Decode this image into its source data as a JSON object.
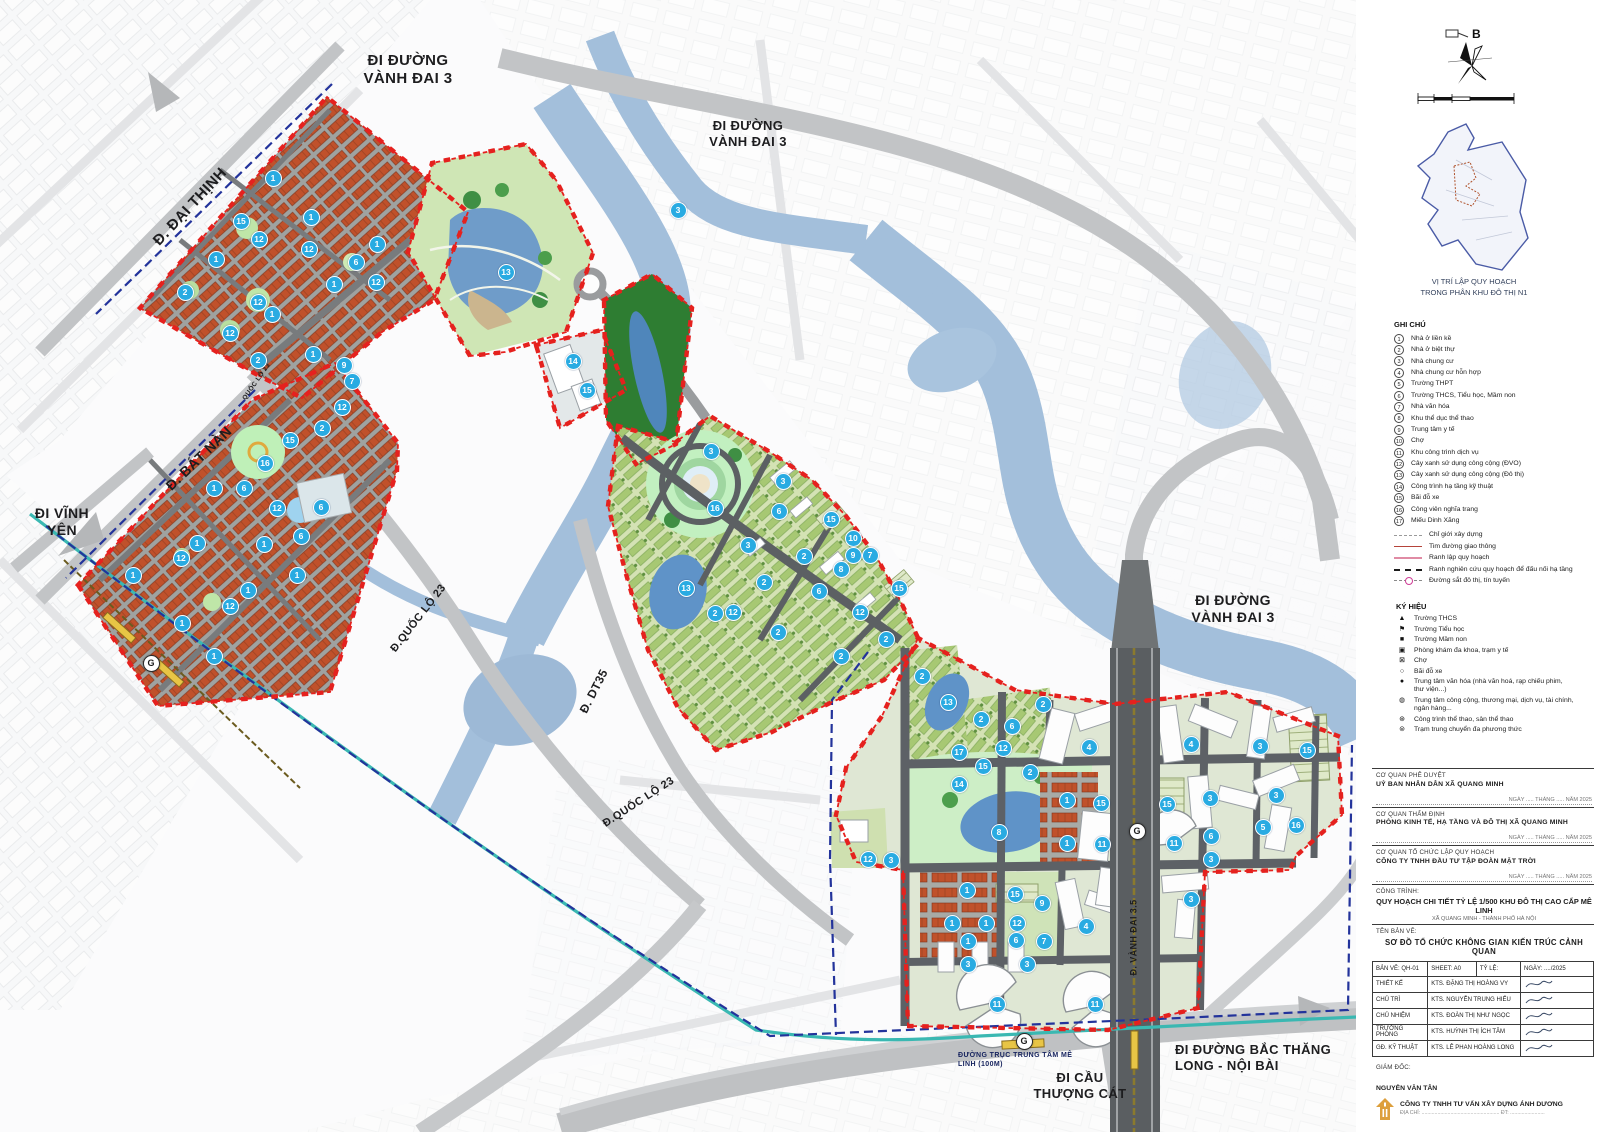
{
  "colors": {
    "marker": "#29abe2",
    "boundary_red": "#e5211e",
    "research_navy": "#23339b",
    "rail_teal": "#3ab8b2",
    "orange_block": "#c0512b",
    "water": "#a3bfdb"
  },
  "compass": {
    "label": "B"
  },
  "inset": {
    "caption1": "VỊ TRÍ LẬP QUY HOẠCH",
    "caption2": "TRONG PHÂN KHU ĐÔ THỊ N1"
  },
  "map": {
    "station_label": "G",
    "stations": [
      {
        "x": 150,
        "y": 662
      },
      {
        "x": 1136,
        "y": 830
      },
      {
        "x": 1023,
        "y": 1040
      }
    ],
    "road_labels": [
      {
        "text": "ĐI ĐƯỜNG\nVÀNH ĐAI 3",
        "x": 338,
        "y": 52,
        "w": 140,
        "rot": 0,
        "size": 15
      },
      {
        "text": "ĐI ĐƯỜNG\nVÀNH ĐAI 3",
        "x": 688,
        "y": 118,
        "w": 120,
        "rot": 0,
        "size": 13
      },
      {
        "text": "ĐI ĐƯỜNG\nVÀNH ĐAI 3",
        "x": 1163,
        "y": 592,
        "w": 140,
        "rot": 0,
        "size": 14
      },
      {
        "text": "Đ. ĐẠI THỊNH",
        "x": 118,
        "y": 198,
        "w": 145,
        "rot": -47,
        "size": 15
      },
      {
        "text": "Đ. BÁT NÀN",
        "x": 133,
        "y": 450,
        "w": 132,
        "rot": -44,
        "size": 14
      },
      {
        "text": "ĐI VĨNH\nYÊN",
        "x": 20,
        "y": 505,
        "w": 84,
        "rot": 0,
        "size": 14
      },
      {
        "text": "Đ.QUỐC LỘ 23",
        "x": 358,
        "y": 612,
        "w": 122,
        "rot": -52,
        "size": 11
      },
      {
        "text": "Đ.QUỐC LỘ 23",
        "x": 578,
        "y": 796,
        "w": 122,
        "rot": -33,
        "size": 11
      },
      {
        "text": "QUỐC LỘ 23",
        "x": 226,
        "y": 378,
        "w": 62,
        "rot": -55,
        "size": 6.5
      },
      {
        "text": "Đ. DT35",
        "x": 558,
        "y": 684,
        "w": 72,
        "rot": -63,
        "size": 12
      },
      {
        "text": "Đ. VÀNH ĐAI 3.5",
        "x": 1086,
        "y": 932,
        "w": 96,
        "rot": -90,
        "size": 9
      },
      {
        "text": "ĐƯỜNG TRỤC TRUNG TÂM MÊ\nLINH (100M)",
        "x": 958,
        "y": 1052,
        "w": 140,
        "rot": 0,
        "size": 7,
        "color": "#16235e",
        "align": "left"
      },
      {
        "text": "ĐI CẦU\nTHƯỢNG CÁT",
        "x": 1018,
        "y": 1070,
        "w": 124,
        "rot": 0,
        "size": 13
      },
      {
        "text": "ĐI ĐƯỜNG BẮC THĂNG\nLONG - NỘI BÀI",
        "x": 1175,
        "y": 1042,
        "w": 185,
        "rot": 0,
        "size": 13,
        "align": "left"
      }
    ],
    "markers": [
      [
        1,
        272,
        177
      ],
      [
        15,
        240,
        220
      ],
      [
        12,
        258,
        238
      ],
      [
        1,
        310,
        216
      ],
      [
        12,
        308,
        248
      ],
      [
        1,
        215,
        258
      ],
      [
        6,
        355,
        261
      ],
      [
        1,
        376,
        243
      ],
      [
        12,
        375,
        281
      ],
      [
        1,
        333,
        283
      ],
      [
        2,
        184,
        291
      ],
      [
        12,
        257,
        301
      ],
      [
        1,
        271,
        313
      ],
      [
        12,
        229,
        332
      ],
      [
        2,
        257,
        359
      ],
      [
        1,
        312,
        353
      ],
      [
        9,
        343,
        364
      ],
      [
        7,
        351,
        380
      ],
      [
        12,
        341,
        406
      ],
      [
        2,
        321,
        427
      ],
      [
        15,
        289,
        439
      ],
      [
        16,
        264,
        462
      ],
      [
        6,
        243,
        487
      ],
      [
        1,
        213,
        487
      ],
      [
        12,
        276,
        507
      ],
      [
        6,
        320,
        506
      ],
      [
        6,
        300,
        535
      ],
      [
        1,
        196,
        542
      ],
      [
        1,
        263,
        543
      ],
      [
        12,
        180,
        557
      ],
      [
        1,
        132,
        574
      ],
      [
        1,
        296,
        574
      ],
      [
        1,
        247,
        589
      ],
      [
        12,
        229,
        605
      ],
      [
        1,
        181,
        622
      ],
      [
        1,
        213,
        655
      ],
      [
        13,
        505,
        271
      ],
      [
        14,
        572,
        360
      ],
      [
        15,
        586,
        389
      ],
      [
        3,
        677,
        209
      ],
      [
        3,
        710,
        450
      ],
      [
        3,
        782,
        480
      ],
      [
        6,
        778,
        510
      ],
      [
        15,
        830,
        518
      ],
      [
        16,
        714,
        507
      ],
      [
        3,
        747,
        544
      ],
      [
        2,
        803,
        555
      ],
      [
        10,
        852,
        537
      ],
      [
        9,
        852,
        554
      ],
      [
        7,
        869,
        554
      ],
      [
        8,
        840,
        568
      ],
      [
        6,
        818,
        590
      ],
      [
        13,
        685,
        587
      ],
      [
        2,
        763,
        581
      ],
      [
        12,
        732,
        611
      ],
      [
        2,
        714,
        612
      ],
      [
        12,
        859,
        611
      ],
      [
        2,
        777,
        631
      ],
      [
        15,
        898,
        587
      ],
      [
        2,
        885,
        638
      ],
      [
        2,
        840,
        655
      ],
      [
        2,
        921,
        675
      ],
      [
        13,
        947,
        701
      ],
      [
        2,
        1042,
        703
      ],
      [
        2,
        980,
        718
      ],
      [
        6,
        1011,
        725
      ],
      [
        12,
        1002,
        747
      ],
      [
        4,
        1088,
        746
      ],
      [
        17,
        958,
        751
      ],
      [
        15,
        982,
        765
      ],
      [
        2,
        1029,
        771
      ],
      [
        14,
        958,
        783
      ],
      [
        1,
        1066,
        799
      ],
      [
        15,
        1100,
        802
      ],
      [
        8,
        998,
        831
      ],
      [
        1,
        1066,
        842
      ],
      [
        11,
        1101,
        843
      ],
      [
        12,
        867,
        858
      ],
      [
        3,
        890,
        859
      ],
      [
        4,
        1190,
        743
      ],
      [
        3,
        1259,
        745
      ],
      [
        15,
        1306,
        749
      ],
      [
        15,
        1166,
        803
      ],
      [
        3,
        1209,
        797
      ],
      [
        3,
        1275,
        794
      ],
      [
        11,
        1173,
        842
      ],
      [
        6,
        1210,
        835
      ],
      [
        5,
        1262,
        826
      ],
      [
        16,
        1295,
        824
      ],
      [
        3,
        1210,
        858
      ],
      [
        3,
        1190,
        898
      ],
      [
        1,
        966,
        889
      ],
      [
        15,
        1014,
        893
      ],
      [
        9,
        1041,
        902
      ],
      [
        1,
        951,
        922
      ],
      [
        1,
        985,
        922
      ],
      [
        12,
        1016,
        922
      ],
      [
        4,
        1085,
        925
      ],
      [
        6,
        1015,
        939
      ],
      [
        7,
        1043,
        940
      ],
      [
        1,
        967,
        940
      ],
      [
        3,
        967,
        963
      ],
      [
        3,
        1026,
        963
      ],
      [
        11,
        996,
        1003
      ],
      [
        11,
        1094,
        1003
      ]
    ]
  },
  "legend": {
    "title": "GHI CHÚ",
    "items": [
      {
        "num": 1,
        "label": "Nhà ở liền kề"
      },
      {
        "num": 2,
        "label": "Nhà ở biệt thự"
      },
      {
        "num": 3,
        "label": "Nhà chung cư"
      },
      {
        "num": 4,
        "label": "Nhà chung cư hỗn hợp"
      },
      {
        "num": 5,
        "label": "Trường THPT"
      },
      {
        "num": 6,
        "label": "Trường THCS, Tiểu học, Mầm non"
      },
      {
        "num": 7,
        "label": "Nhà văn hóa"
      },
      {
        "num": 8,
        "label": "Khu thể dục thể thao"
      },
      {
        "num": 9,
        "label": "Trung tâm y tế"
      },
      {
        "num": 10,
        "label": "Chợ"
      },
      {
        "num": 11,
        "label": "Khu công trình dịch vụ"
      },
      {
        "num": 12,
        "label": "Cây xanh sử dụng công cộng (ĐVO)"
      },
      {
        "num": 13,
        "label": "Cây xanh sử dụng công cộng (Đô thị)"
      },
      {
        "num": 14,
        "label": "Công trình hạ tầng kỹ thuật"
      },
      {
        "num": 15,
        "label": "Bãi đỗ xe"
      },
      {
        "num": 16,
        "label": "Công viên nghĩa trang"
      },
      {
        "num": 17,
        "label": "Miếu Dinh Xăng"
      }
    ],
    "lines": [
      {
        "style": "construction",
        "label": "Chỉ giới xây dựng"
      },
      {
        "style": "road-axis",
        "label": "Tim đường giao thông"
      },
      {
        "style": "planning",
        "label": "Ranh lập quy hoạch"
      },
      {
        "style": "research",
        "label": "Ranh nghiên cứu quy hoạch để đấu nối hạ tầng"
      },
      {
        "style": "rail",
        "label": "Đường sắt đô thị, tín tuyến"
      }
    ]
  },
  "symbols": {
    "title": "KÝ HIỆU",
    "items": [
      {
        "glyph": "▲",
        "label": "Trường THCS"
      },
      {
        "glyph": "⚑",
        "label": "Trường Tiểu học"
      },
      {
        "glyph": "■",
        "label": "Trường Mầm non"
      },
      {
        "glyph": "▣",
        "label": "Phòng khám đa khoa, trạm y tế"
      },
      {
        "glyph": "⊠",
        "label": "Chợ"
      },
      {
        "glyph": "○",
        "label": "Bãi đỗ xe"
      },
      {
        "glyph": "●",
        "label": "Trung tâm văn hóa (nhà văn hoá, rạp chiếu phim, thư viện...)"
      },
      {
        "glyph": "◍",
        "label": "Trung tâm công cộng, thương mại, dịch vụ, tài chính, ngân hàng..."
      },
      {
        "glyph": "⊛",
        "label": "Công trình thể thao, sân thể thao"
      },
      {
        "glyph": "⊜",
        "label": "Trạm trung chuyển đa phương thức"
      }
    ]
  },
  "titleblock": {
    "approve_label": "CƠ QUAN PHÊ DUYỆT",
    "approve_value": "UỶ BAN NHÂN DÂN XÃ QUANG MINH",
    "sig_line": "NGÀY ..... THÁNG ..... NĂM 2025",
    "agency2_label": "CƠ QUAN THẨM ĐỊNH",
    "agency2_value": "PHÒNG KINH TẾ, HẠ TẦNG VÀ ĐÔ THỊ XÃ QUANG MINH",
    "agency3_label": "CƠ QUAN TỔ CHỨC LẬP QUY HOẠCH",
    "agency3_value": "CÔNG TY TNHH ĐẦU TƯ TẬP ĐOÀN MẶT TRỜI",
    "project_label": "CÔNG TRÌNH:",
    "project_title": "QUY HOẠCH CHI TIẾT TỶ LỆ 1/500 KHU ĐÔ THỊ CAO CẤP MÊ LINH",
    "project_location": "XÃ QUANG MINH - THÀNH PHỐ HÀ NỘI",
    "drawing_label": "TÊN BẢN VẼ:",
    "drawing_title": "SƠ ĐỒ TỔ CHỨC KHÔNG GIAN KIẾN TRÚC CẢNH QUAN",
    "table": {
      "col1": "BẢN VẼ: QH-01",
      "col2": "SHEET: A0",
      "col3": "TỶ LỆ:",
      "col4": "NGÀY: ..../2025",
      "rows": [
        [
          "THIẾT KẾ",
          "KTS. ĐẶNG THỊ HOÀNG VY"
        ],
        [
          "CHỦ TRÌ",
          "KTS. NGUYỄN TRUNG HIẾU"
        ],
        [
          "CHỦ NHIỆM",
          "KTS. ĐOÀN THỊ NHƯ NGỌC"
        ],
        [
          "TRƯỞNG PHÒNG",
          "KTS. HUỲNH THỊ ÍCH TÂM"
        ],
        [
          "GĐ. KỸ THUẬT",
          "KTS. LÊ PHAN HOÀNG LONG"
        ]
      ]
    },
    "director_label": "GIÁM ĐỐC:",
    "director_name": "NGUYỄN VĂN TÂN",
    "company": "CÔNG TY TNHH TƯ VẤN XÂY DỰNG ÁNH DƯƠNG",
    "company_sub": "ĐỊA CHỈ: ......................................................  ĐT: ........................"
  }
}
